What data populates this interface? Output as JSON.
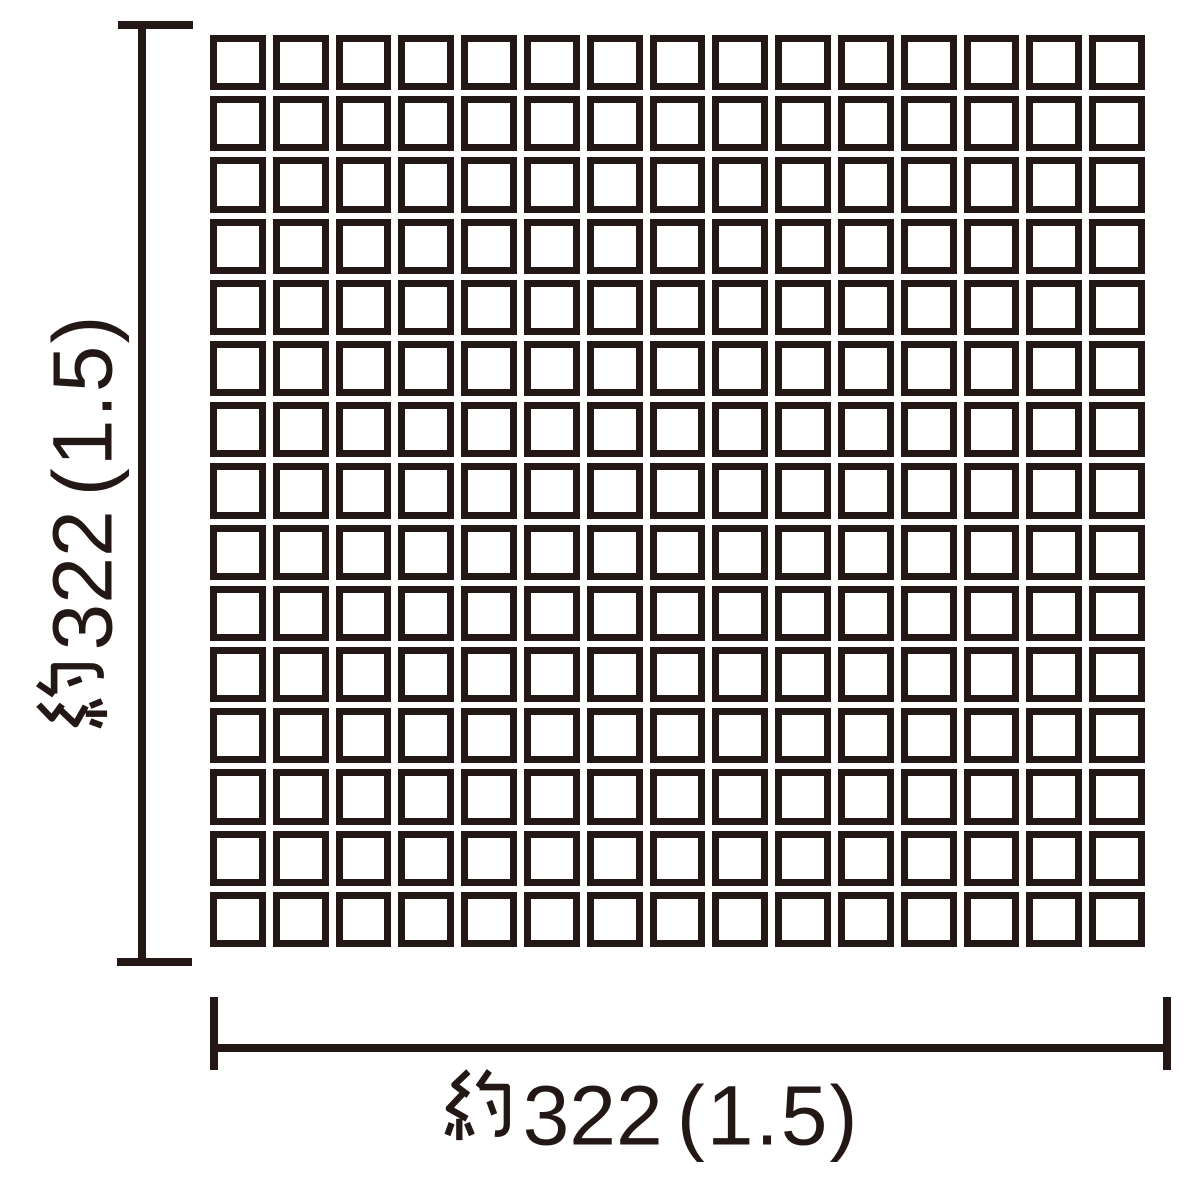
{
  "diagram": {
    "background_color": "#ffffff",
    "ink_color": "#231815",
    "grid": {
      "rows": 15,
      "columns": 15,
      "tile_shape": "square"
    },
    "dimensions": {
      "vertical": {
        "full_text": "約322（1.5）",
        "approx_prefix": "約",
        "value": "322",
        "paren_value": "(1.5)"
      },
      "horizontal": {
        "full_text": "約322（1.5）",
        "approx_prefix": "約",
        "value": "322",
        "paren_value": "(1.5)"
      }
    }
  }
}
